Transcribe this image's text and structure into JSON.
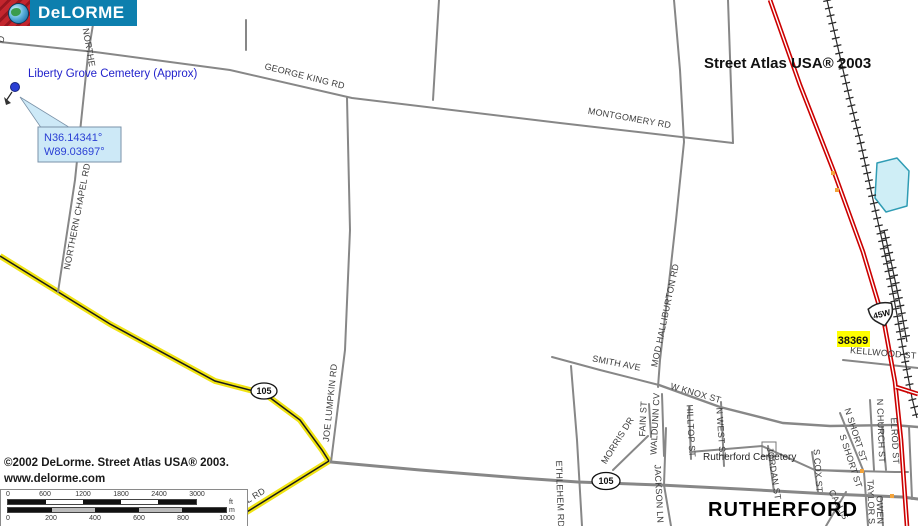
{
  "logo": {
    "brand": "DeLORME"
  },
  "header": {
    "edition": "Street Atlas USA® 2003"
  },
  "poi": {
    "liberty_grove": "Liberty Grove Cemetery (Approx)",
    "rutherford_cemetery": "Rutherford Cemetery",
    "city": "RUTHERFORD"
  },
  "callout": {
    "lat": "N36.14341°",
    "lon": "W89.03697°"
  },
  "markers": {
    "route_main": "105",
    "route_nw": "105",
    "us_shield": "45W",
    "address_flag": "38369"
  },
  "roads": {
    "partial_d": "D",
    "northe": "NORTHE",
    "george_king": "GEORGE KING RD",
    "montgomery": "MONTGOMERY RD",
    "northern_chapel": "NORTHERN CHAPEL RD",
    "joe_lumpkin": "JOE LUMPKIN RD",
    "mod_halliburton": "MOD HALLIBURTON RD",
    "smith_ave": "SMITH AVE",
    "w_knox": "W KNOX ST",
    "morris": "MORRIS DR",
    "fain": "FAIN ST",
    "waldunn": "WALDUNN CV",
    "hilltop": "HILLTOP ST",
    "n_west": "N WEST ST",
    "bethlehem": "ETHLEHEM RD",
    "jackson": "JACKSON LN",
    "jordan": "JORDAN ST",
    "s_cox": "S COX ST",
    "n_short": "N SHORT ST",
    "s_short": "S SHORT ST",
    "n_church": "N CHURCH ST",
    "elrod": "ELROD ST",
    "kellwood": "KELLWOOD ST",
    "taylor": "TAYLOR S",
    "owen": "OWEN",
    "callis": "CALLIS",
    "l_rd": "L RD"
  },
  "footer": {
    "copyright": "©2002 DeLorme. Street Atlas USA® 2003.",
    "website": "www.delorme.com"
  },
  "scale": {
    "ft_ticks": [
      "0",
      "600",
      "1200",
      "1800",
      "2400",
      "3000"
    ],
    "m_ticks": [
      "0",
      "200",
      "400",
      "600",
      "800",
      "1000"
    ],
    "ft_unit": "ft",
    "m_unit": "m"
  },
  "colors": {
    "highway_red": "#cc0000",
    "route_yellow": "#f0e312",
    "water_fill": "#cfeef6",
    "water_edge": "#2f9cb4",
    "highlight_yellow": "#ffff00",
    "callout_fill": "#cde9f7",
    "label_blue": "#2a3fd4",
    "logo_blue": "#0d7fae",
    "logo_red": "#c4262e"
  }
}
